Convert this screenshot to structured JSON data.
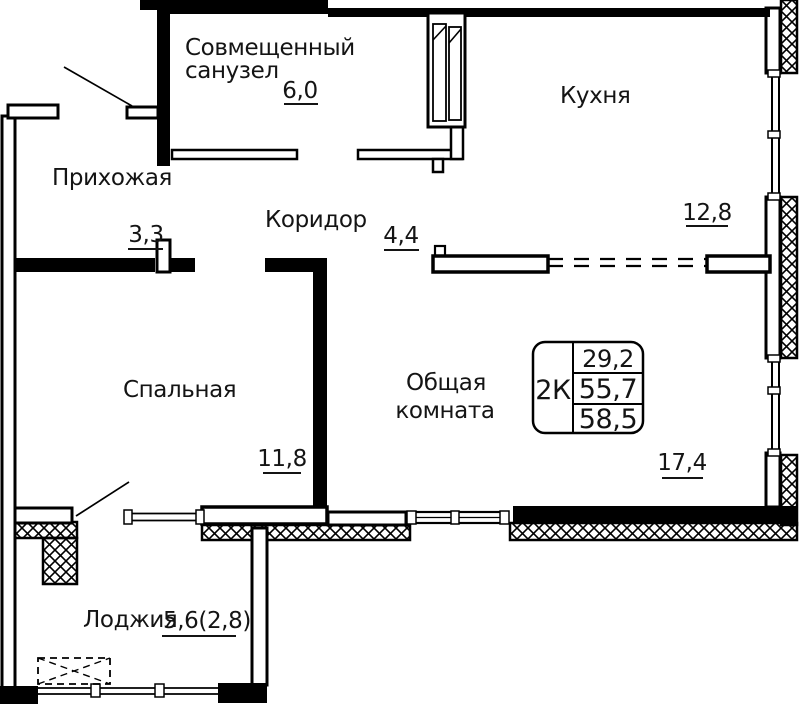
{
  "floor_plan": {
    "rooms": {
      "bathroom": {
        "name_line1": "Совмещенный",
        "name_line2": "санузел",
        "area": "6,0"
      },
      "kitchen": {
        "name": "Кухня",
        "area": "12,8"
      },
      "hallway": {
        "name": "Прихожая",
        "area": "3,3"
      },
      "corridor": {
        "name": "Коридор",
        "area": "4,4"
      },
      "bedroom": {
        "name": "Спальная",
        "area": "11,8"
      },
      "living_room": {
        "name_line1": "Общая",
        "name_line2": "комната",
        "area": "17,4"
      },
      "loggia": {
        "name": "Лоджия",
        "area": "5,6(2,8)"
      }
    },
    "info_table": {
      "type": "2К",
      "row1": "29,2",
      "row2": "55,7",
      "row3": "58,5"
    },
    "colors": {
      "wall": "#000000",
      "background": "#ffffff",
      "text": "#141414"
    }
  }
}
